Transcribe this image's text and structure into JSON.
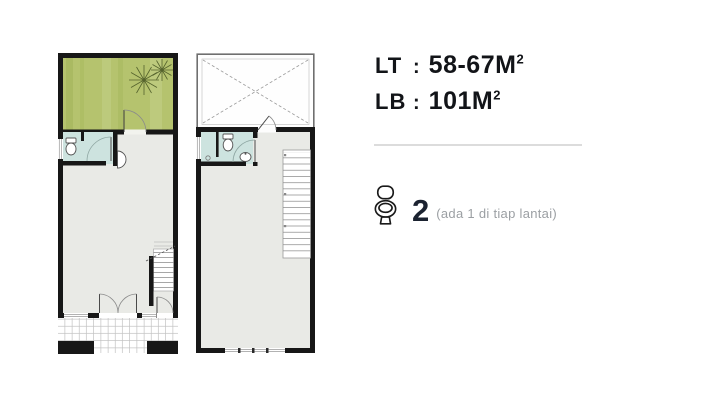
{
  "specs": {
    "lt": {
      "label": "LT",
      "colon": ":",
      "value": "58-67M",
      "sup": "2"
    },
    "lb": {
      "label": "LB",
      "colon": ":",
      "value": "101M",
      "sup": "2"
    }
  },
  "bathrooms": {
    "icon": "toilet-icon",
    "count": "2",
    "note": "(ada 1 di tiap lantai)"
  },
  "colors": {
    "wall": "#171717",
    "garden_green": "#b5c36e",
    "bathroom_teal": "#cde3df",
    "floor_gray": "#e9eae6",
    "tile_line": "#b8b8b8",
    "text_dark": "#121418",
    "count_navy": "#1b2230",
    "note_gray": "#9b9fa3",
    "divider_gray": "#dcdcdc"
  }
}
